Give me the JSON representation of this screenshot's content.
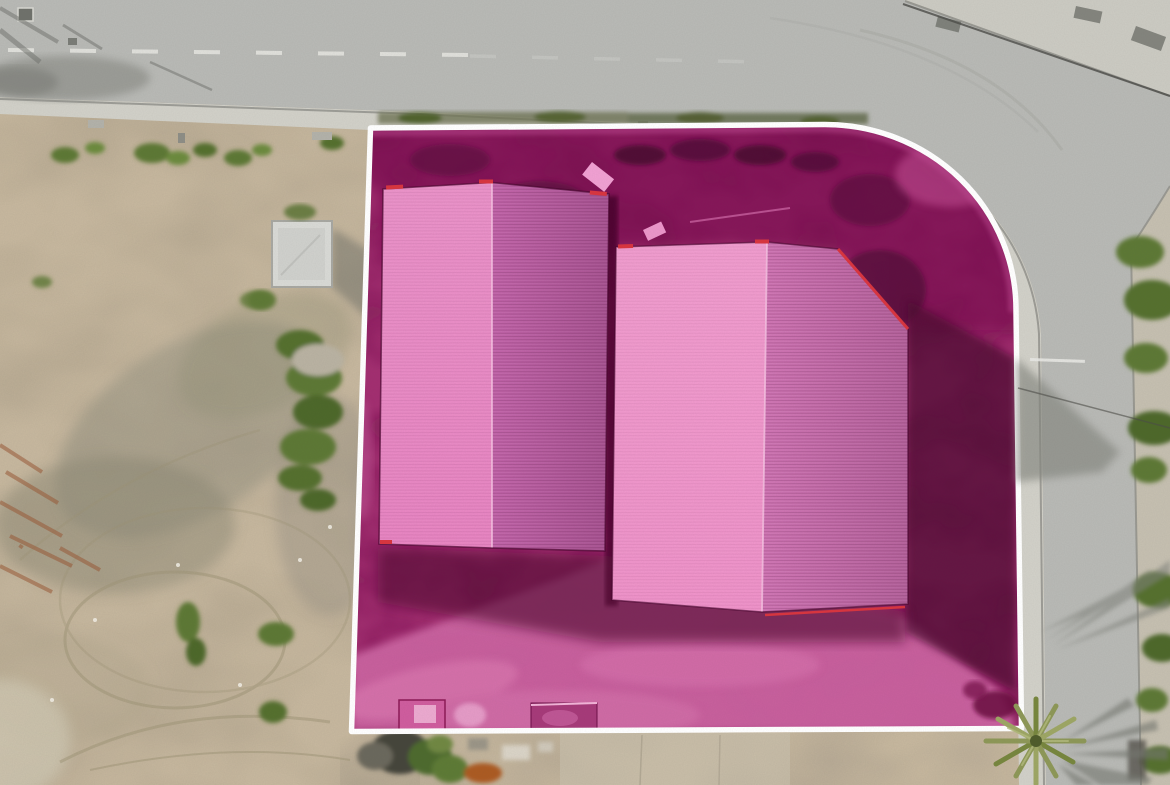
{
  "scene": {
    "type": "aerial-drone-photo-with-parcel-highlight",
    "description": "Top-down aerial photograph of a corner industrial plot at a road junction. The plot is highlighted with a translucent magenta overlay and outlined with a white boundary line with a rounded top-right corner. Inside the plot are two large pink-tinted warehouse roofs with vertical ridge lines. A dirt lot with weeds and tire tracks lies to the left, an asphalt road runs along the top and down the right side with light concrete sidewalks, a small grey shed sits outside the plot on the left, and a palm tree stands at the bottom-right corner casting a shadow across the road."
  },
  "annotation": {
    "kind": "property-parcel-highlight",
    "boundary_style": "solid white outline, rounded at street corner",
    "highlight_style": "magenta tint over ground and roofs"
  },
  "colors": {
    "dirt_base": "#c6b79e",
    "dirt_patch": "#998f7a",
    "road": "#b8b9b5",
    "sidewalk": "#d1d0c8",
    "sidewalk_right": "#c5bfb0",
    "sidewalk_topright": "#cbcac2",
    "curb": "#8f8f89",
    "lane_dash": "#e8e8e4",
    "parcel_overlay": "#a22e70",
    "parcel_dark": "#7a1150",
    "parcel_light_dirt": "#ca64a0",
    "parcel_shadow": "#4e0730",
    "boundary": "#ffffff",
    "roof_left_sun": "#e884c2",
    "roof_left_shade": "#c263a9",
    "roof_right_sun": "#ef92c9",
    "roof_right_shade": "#cf73b3",
    "roof_red_trim": "#d8353f",
    "ridge_highlight": "#f7c5e4",
    "shed_roof": "#d8d9d5",
    "shed_shadow": "#6e6f68",
    "vegetation": "#5d7834",
    "vegetation_dark": "#44591f",
    "palm_frond": "#8d9757",
    "wire": "#4c4c48",
    "shadow_on_road": "#84867f",
    "junk_dark": "#45443a",
    "junk_orange": "#ab5a24",
    "bright_panel": "#f0a0d2"
  }
}
